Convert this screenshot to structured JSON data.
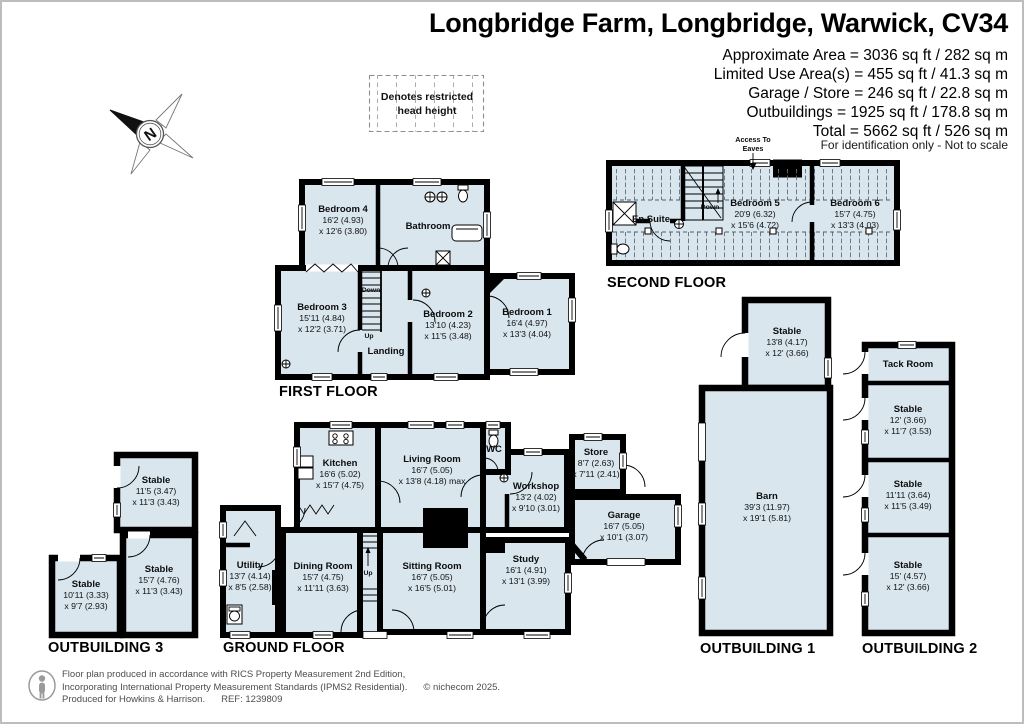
{
  "page": {
    "title": "Longbridge Farm, Longbridge, Warwick, CV34"
  },
  "header": {
    "area_lines": [
      "Approximate Area = 3036 sq ft / 282 sq m",
      "Limited Use Area(s) = 455 sq ft / 41.3 sq m",
      "Garage / Store = 246 sq ft / 22.8 sq m",
      "Outbuildings = 1925 sq ft / 178.8 sq m",
      "Total = 5662 sq ft / 526 sq m"
    ],
    "disclaimer": "For identification only - Not to scale"
  },
  "legend": {
    "line1": "Denotes restricted",
    "line2": "head height"
  },
  "compass": {
    "north": "N"
  },
  "floors": {
    "second": {
      "label": "SECOND FLOOR",
      "access1": "Access To",
      "access2": "Eaves",
      "down": "Down",
      "ensuite": {
        "name": "En Suite"
      },
      "bed5": {
        "name": "Bedroom 5",
        "d1": "20'9 (6.32)",
        "d2": "x 15'6 (4.72)"
      },
      "bed6": {
        "name": "Bedroom 6",
        "d1": "15'7 (4.75)",
        "d2": "x 13'3 (4.03)"
      }
    },
    "first": {
      "label": "FIRST FLOOR",
      "down": "Down",
      "up": "Up",
      "bed4": {
        "name": "Bedroom 4",
        "d1": "16'2 (4.93)",
        "d2": "x 12'6 (3.80)"
      },
      "bathroom": {
        "name": "Bathroom"
      },
      "bed3": {
        "name": "Bedroom 3",
        "d1": "15'11 (4.84)",
        "d2": "x 12'2 (3.71)"
      },
      "landing": {
        "name": "Landing"
      },
      "bed2": {
        "name": "Bedroom 2",
        "d1": "13'10 (4.23)",
        "d2": "x 11'5 (3.48)"
      },
      "bed1": {
        "name": "Bedroom 1",
        "d1": "16'4 (4.97)",
        "d2": "x 13'3 (4.04)"
      }
    },
    "ground": {
      "label": "GROUND FLOOR",
      "up": "Up",
      "kitchen": {
        "name": "Kitchen",
        "d1": "16'6 (5.02)",
        "d2": "x 15'7 (4.75)"
      },
      "living": {
        "name": "Living Room",
        "d1": "16'7 (5.05)",
        "d2": "x 13'8 (4.18) max"
      },
      "wc": {
        "name": "WC"
      },
      "workshop": {
        "name": "Workshop",
        "d1": "13'2 (4.02)",
        "d2": "x 9'10 (3.01)"
      },
      "store": {
        "name": "Store",
        "d1": "8'7 (2.63)",
        "d2": "x 7'11 (2.41)"
      },
      "garage": {
        "name": "Garage",
        "d1": "16'7 (5.05)",
        "d2": "x 10'1 (3.07)"
      },
      "study": {
        "name": "Study",
        "d1": "16'1 (4.91)",
        "d2": "x 13'1 (3.99)"
      },
      "sitting": {
        "name": "Sitting Room",
        "d1": "16'7 (5.05)",
        "d2": "x 16'5 (5.01)"
      },
      "dining": {
        "name": "Dining Room",
        "d1": "15'7 (4.75)",
        "d2": "x 11'11 (3.63)"
      },
      "utility": {
        "name": "Utility",
        "d1": "13'7 (4.14)",
        "d2": "x 8'5 (2.58)"
      }
    }
  },
  "outbuildings": {
    "ob1": {
      "label": "OUTBUILDING 1",
      "stable": {
        "name": "Stable",
        "d1": "13'8 (4.17)",
        "d2": "x 12' (3.66)"
      },
      "barn": {
        "name": "Barn",
        "d1": "39'3 (11.97)",
        "d2": "x 19'1 (5.81)"
      }
    },
    "ob2": {
      "label": "OUTBUILDING 2",
      "tack": {
        "name": "Tack Room"
      },
      "s1": {
        "name": "Stable",
        "d1": "12' (3.66)",
        "d2": "x 11'7 (3.53)"
      },
      "s2": {
        "name": "Stable",
        "d1": "11'11 (3.64)",
        "d2": "x 11'5 (3.49)"
      },
      "s3": {
        "name": "Stable",
        "d1": "15' (4.57)",
        "d2": "x 12' (3.66)"
      }
    },
    "ob3": {
      "label": "OUTBUILDING 3",
      "s1": {
        "name": "Stable",
        "d1": "11'5 (3.47)",
        "d2": "x 11'3 (3.43)"
      },
      "s2": {
        "name": "Stable",
        "d1": "15'7 (4.76)",
        "d2": "x 11'3 (3.43)"
      },
      "s3": {
        "name": "Stable",
        "d1": "10'11 (3.33)",
        "d2": "x 9'7 (2.93)"
      }
    }
  },
  "footer": {
    "line1": "Floor plan produced in accordance with RICS Property Measurement 2nd Edition,",
    "line2": "Incorporating International Property Measurement Standards (IPMS2 Residential).",
    "copyright": "© nichecom 2025.",
    "line3a": "Produced for Howkins & Harrison.",
    "ref": "REF: 1239809"
  },
  "colors": {
    "room_fill": "#d9e6ee",
    "wall": "#000000",
    "hatch": "#5f6e7a"
  }
}
